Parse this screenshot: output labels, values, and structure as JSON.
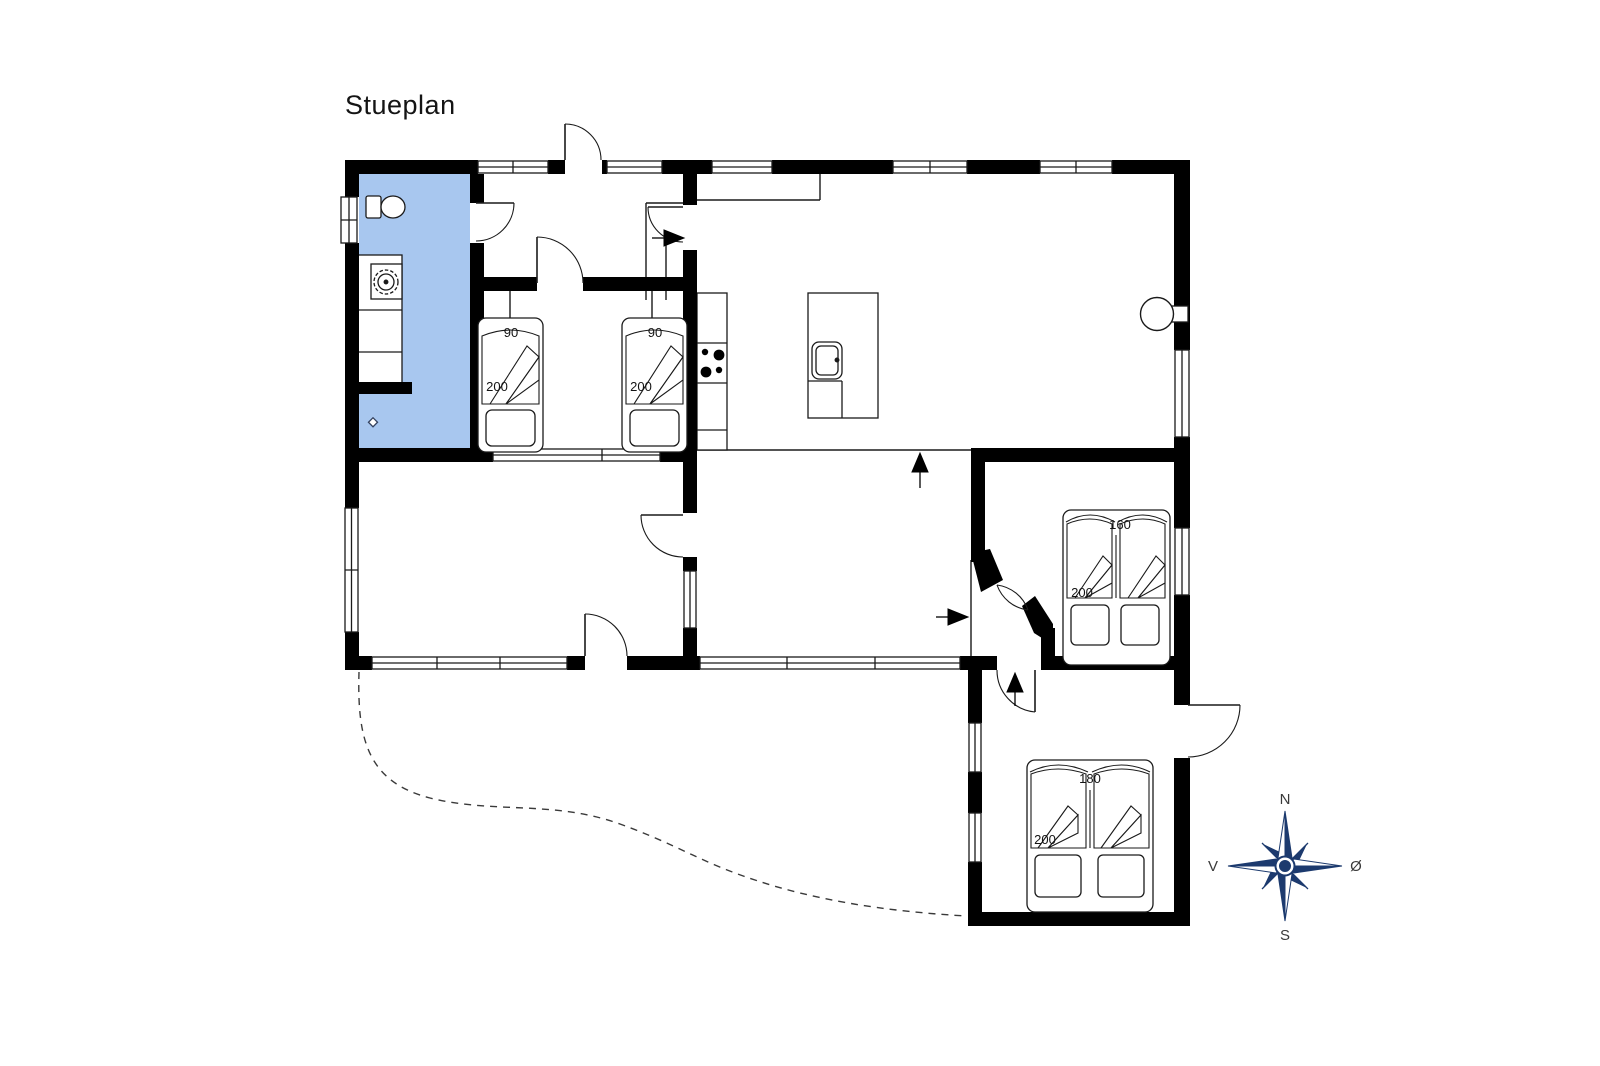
{
  "title": "Stueplan",
  "colors": {
    "wall": "#000000",
    "bathroom_fill": "#A8C7EF",
    "compass_navy": "#1C3A6E",
    "background": "#ffffff"
  },
  "labels": {
    "bed_single_left": {
      "width": "90",
      "length": "200"
    },
    "bed_single_right": {
      "width": "90",
      "length": "200"
    },
    "bed_double_160": {
      "width": "160",
      "length": "200"
    },
    "bed_double_180": {
      "width": "180",
      "length": "200"
    }
  },
  "compass": {
    "north": "N",
    "south": "S",
    "west": "V",
    "east": "Ø"
  }
}
